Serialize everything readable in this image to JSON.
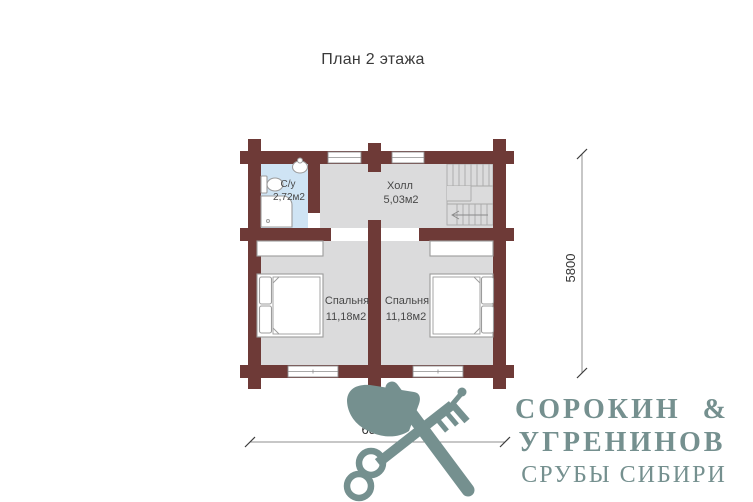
{
  "title": "План 2 этажа",
  "rooms": {
    "bathroom": {
      "name": "С/у",
      "area": "2,72м2"
    },
    "hall": {
      "name": "Холл",
      "area": "5,03м2"
    },
    "bedroom_left": {
      "name": "Спальня",
      "area": "11,18м2"
    },
    "bedroom_right": {
      "name": "Спальня",
      "area": "11,18м2"
    }
  },
  "dimensions": {
    "vertical": "5800",
    "horizontal": "6800"
  },
  "logo": {
    "line1": "СОРОКИН &",
    "line2": "УГРЕНИНОВ",
    "line3": "СРУБЫ СИБИРИ",
    "emblem": "crossed-axe-and-key"
  },
  "colors": {
    "wall": "#6e3a37",
    "floor": "#dbdbdc",
    "bathroom_floor": "#cfe4f4",
    "logo_teal": "#75908f",
    "furniture_stroke": "#9c9c9c",
    "text_dark": "#3a3a3a"
  }
}
